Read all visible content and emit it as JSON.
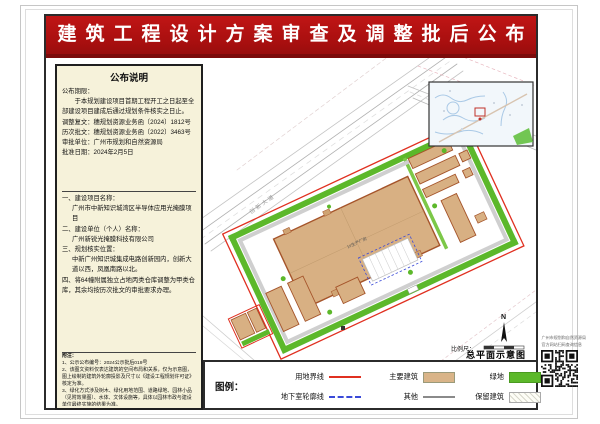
{
  "title": "建筑工程设计方案审查及调整批后公布",
  "announcement": {
    "heading": "公布说明",
    "period_label": "公布期限：",
    "period_text": "于本规划建设项目首期工程开工之日起至全部建设项目建成后通过规划条件核实之日止。",
    "lines": [
      "调整复文：穗规划资源业务函〔2024〕1812号",
      "历次批文：穗规划资源业务函〔2022〕3463号",
      "审批单位：广州市规划和自然资源局",
      "批准日期：2024年2月5日"
    ]
  },
  "project": {
    "items": [
      "一、建设项目名称：",
      "广州市中新知识城湾区半导体应用光掩膜项目",
      "二、建设单位（个人）名称：",
      "广州新锐光掩膜科技有限公司",
      "三、规划核实位置：",
      "中新广州知识城集成电路创新园内，创新大道以西，凤凰南路以北。",
      "四、将64幢附属独立占地丙类仓库调整为甲类仓库，其余均按历次批文的审批要求办理。"
    ]
  },
  "notes": {
    "heading": "附注：",
    "items": [
      "1、公示公布编号：2024公示批后019号",
      "2、该图文资料仅表达建筑的空间布局和关系，仅为示意图，图上绘制的建筑外轮廓投影及尺寸以《建设工程规划许可证》核定为准。",
      "3、绿化方式涉及树木、绿化用地范围、道路绿地、园林小品（见附效果图）、水体、文体设施等，具体以园林市政与建设单位最终实施的结果为准。",
      "4、建设单位联系电话：18113049946",
      "5、查询网站：http://ghzyj.gz.gov.cn/ywpd/cxgh/ghgsgb/pqgb/"
    ]
  },
  "map": {
    "road_label": "创新大道",
    "building_label": "1#生产厂房",
    "north_label": "N",
    "scale_label": "比例尺：",
    "caption": "总平面示意图"
  },
  "legend": {
    "heading": "图例：",
    "items": [
      {
        "label": "用地界线"
      },
      {
        "label": "主要建筑"
      },
      {
        "label": "绿地"
      },
      {
        "label": "地下室轮廓线"
      },
      {
        "label": "其他"
      },
      {
        "label": "保留建筑"
      }
    ]
  },
  "qr": {
    "line1": "广州市规划和自然资源局",
    "line2": "官方网站扫码查询信息"
  },
  "colors": {
    "banner_red": "#a80f0f",
    "boundary_red": "#e03020",
    "building_tan": "#d9b488",
    "green": "#5cb82a",
    "underground_blue": "#3a4ad8"
  }
}
